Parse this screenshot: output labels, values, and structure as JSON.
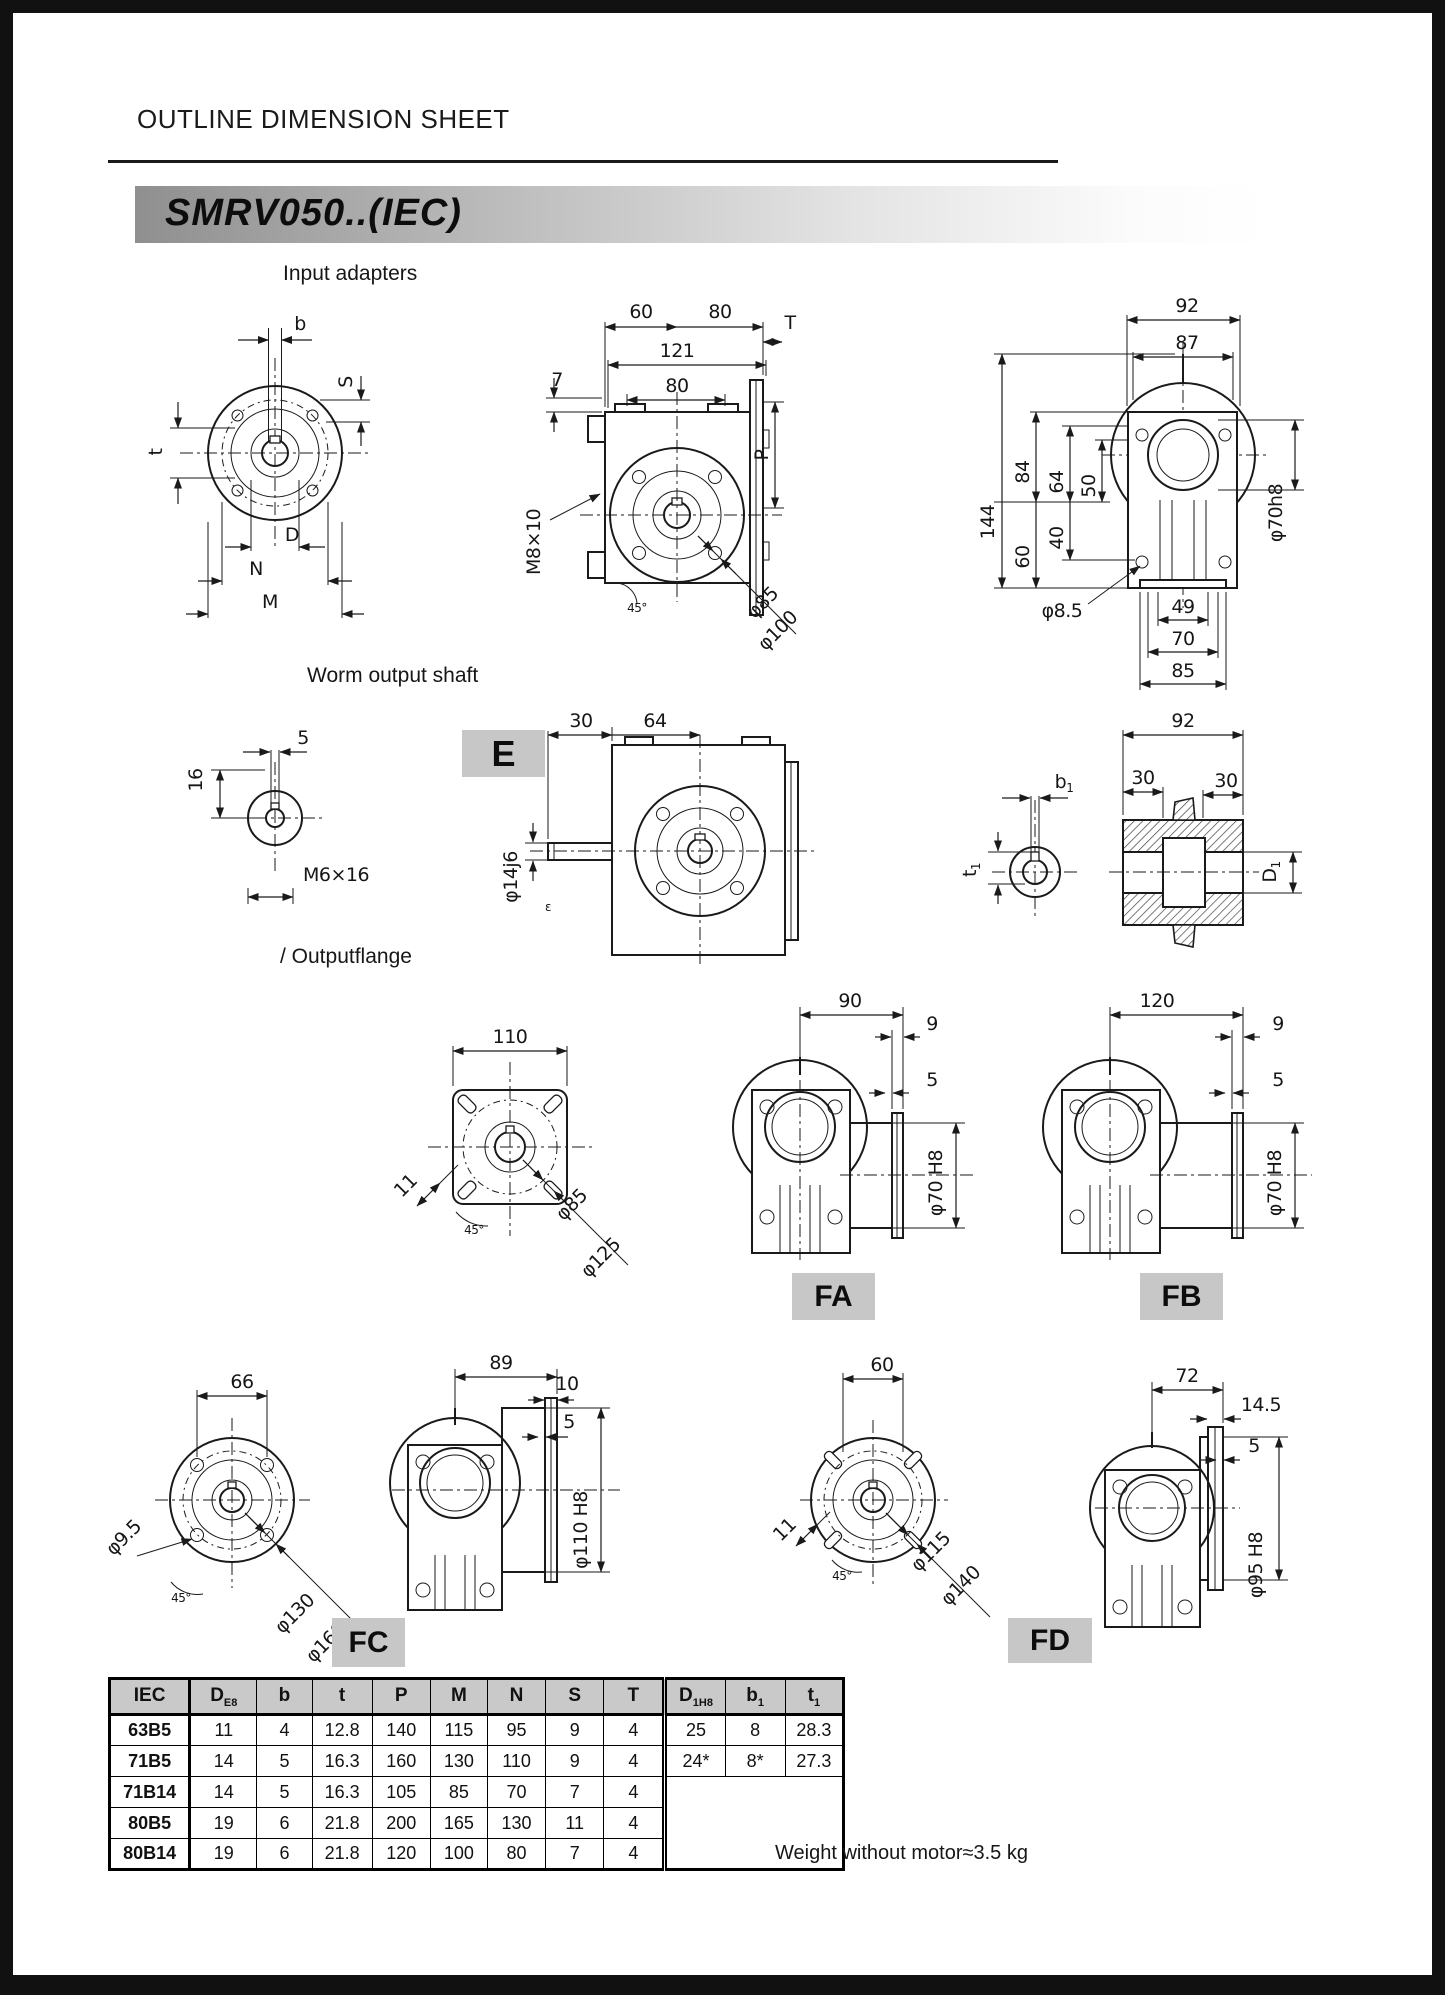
{
  "page": {
    "title": "OUTLINE DIMENSION SHEET",
    "banner": "SMRV050..(IEC)",
    "weight_note": "Weight without motor≈3.5 kg"
  },
  "sections": {
    "input_adapters": "Input adapters",
    "worm_output_shaft": "Worm output shaft",
    "output_flange": "/ Outputflange"
  },
  "badges": {
    "e": "E",
    "fa": "FA",
    "fb": "FB",
    "fc": "FC",
    "fd": "FD"
  },
  "adapter_face": {
    "b": "b",
    "s": "S",
    "t": "t",
    "d": "D",
    "n": "N",
    "m": "M"
  },
  "adapter_side": {
    "w60": "60",
    "w80": "80",
    "w121": "121",
    "w80b": "80",
    "h7": "7",
    "m8": "M8×10",
    "t": "T",
    "p": "P",
    "dia85": "φ85",
    "dia100": "φ100",
    "ang": "45°"
  },
  "adapter_back": {
    "w92": "92",
    "w87": "87",
    "h144": "144",
    "h84": "84",
    "h64": "64",
    "h50": "50",
    "h40": "40",
    "h60": "60",
    "dia70": "φ70h8",
    "dia85": "φ8.5",
    "w49": "49",
    "w70": "70",
    "w85": "85"
  },
  "shaft_face": {
    "w5": "5",
    "h16": "16",
    "tap": "M6×16"
  },
  "shaft_side": {
    "w30": "30",
    "w64": "64",
    "dia14": "φ14j6",
    "eps": "ε"
  },
  "bore_face": {
    "b1m": "b",
    "b1s": "1",
    "t1m": "t",
    "t1s": "1"
  },
  "hub": {
    "w92": "92",
    "w30l": "30",
    "w30r": "30",
    "d1m": "D",
    "d1s": "1"
  },
  "flange110": {
    "w110": "110",
    "w11": "11",
    "ang": "45°",
    "dia85": "φ85",
    "dia125": "φ125"
  },
  "fa": {
    "w90": "90",
    "w9": "9",
    "w5": "5",
    "bore": "φ70 H8"
  },
  "fb": {
    "w120": "120",
    "w9": "9",
    "w5": "5",
    "bore": "φ70 H8"
  },
  "fc_face": {
    "w66": "66",
    "dia95": "φ9.5",
    "ang": "45°",
    "dia130": "φ130",
    "dia160": "φ160"
  },
  "fc": {
    "w89": "89",
    "w10": "10",
    "w5": "5",
    "bore": "φ110 H8"
  },
  "fd_face": {
    "w60": "60",
    "w11": "11",
    "ang": "45°",
    "dia115": "φ115",
    "dia140": "φ140"
  },
  "fd": {
    "w72": "72",
    "w145": "14.5",
    "w5": "5",
    "bore": "φ95 H8"
  },
  "colors": {
    "accent_gray": "#c9c9c9",
    "line": "#1a1a1a"
  },
  "table": {
    "headers": [
      {
        "main": "IEC",
        "sub": ""
      },
      {
        "main": "D",
        "sub": "E8"
      },
      {
        "main": "b",
        "sub": ""
      },
      {
        "main": "t",
        "sub": ""
      },
      {
        "main": "P",
        "sub": ""
      },
      {
        "main": "M",
        "sub": ""
      },
      {
        "main": "N",
        "sub": ""
      },
      {
        "main": "S",
        "sub": ""
      },
      {
        "main": "T",
        "sub": ""
      },
      {
        "main": "D",
        "sub": "1H8"
      },
      {
        "main": "b",
        "sub": "1"
      },
      {
        "main": "t",
        "sub": "1"
      }
    ],
    "rows": [
      [
        "63B5",
        "11",
        "4",
        "12.8",
        "140",
        "115",
        "95",
        "9",
        "4"
      ],
      [
        "71B5",
        "14",
        "5",
        "16.3",
        "160",
        "130",
        "110",
        "9",
        "4"
      ],
      [
        "71B14",
        "14",
        "5",
        "16.3",
        "105",
        "85",
        "70",
        "7",
        "4"
      ],
      [
        "80B5",
        "19",
        "6",
        "21.8",
        "200",
        "165",
        "130",
        "11",
        "4"
      ],
      [
        "80B14",
        "19",
        "6",
        "21.8",
        "120",
        "100",
        "80",
        "7",
        "4"
      ]
    ],
    "right_rows": [
      [
        "25",
        "8",
        "28.3"
      ],
      [
        "24*",
        "8*",
        "27.3"
      ]
    ]
  }
}
